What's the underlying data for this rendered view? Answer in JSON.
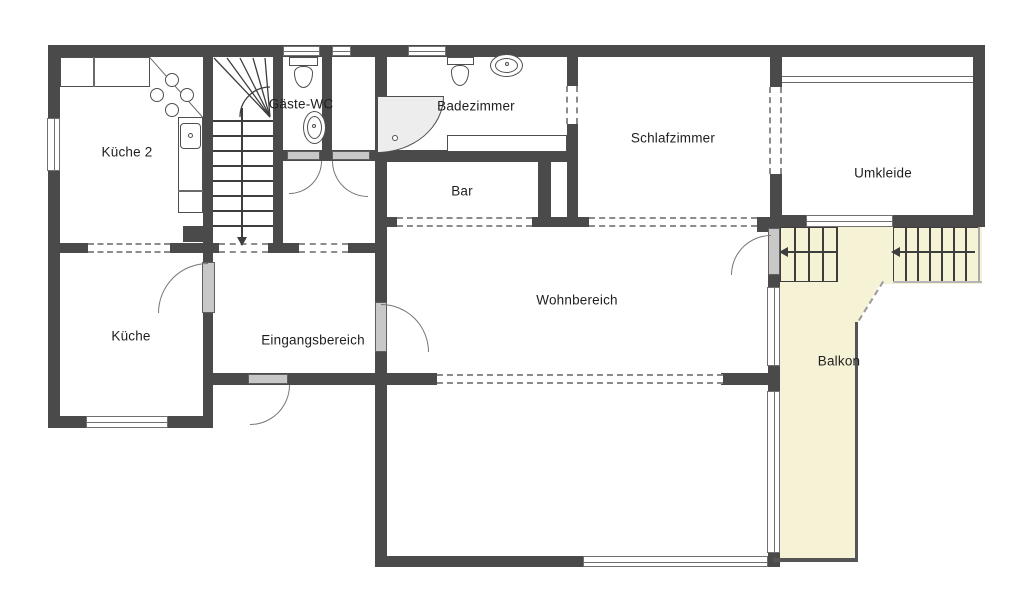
{
  "rooms": {
    "kueche2": {
      "label": "Küche 2"
    },
    "gaeste_wc": {
      "label": "Gäste-WC"
    },
    "badezimmer": {
      "label": "Badezimmer"
    },
    "bar": {
      "label": "Bar"
    },
    "schlafzimmer": {
      "label": "Schlafzimmer"
    },
    "umkleide": {
      "label": "Umkleide"
    },
    "kueche": {
      "label": "Küche"
    },
    "eingangsbereich": {
      "label": "Eingangsbereich"
    },
    "wohnbereich": {
      "label": "Wohnbereich"
    },
    "balkon": {
      "label": "Balkon"
    }
  },
  "colors": {
    "wall": "#4a4a4a",
    "balcony": "#f6f2d5",
    "leaf": "#c8c8c8",
    "leaf_border": "#5f5f5f",
    "window_border": "#707070",
    "dash": "#8c8c8c",
    "fixture": "#4f4f4f",
    "stair": "#3d3d3d",
    "text": "#1f1f1f"
  }
}
